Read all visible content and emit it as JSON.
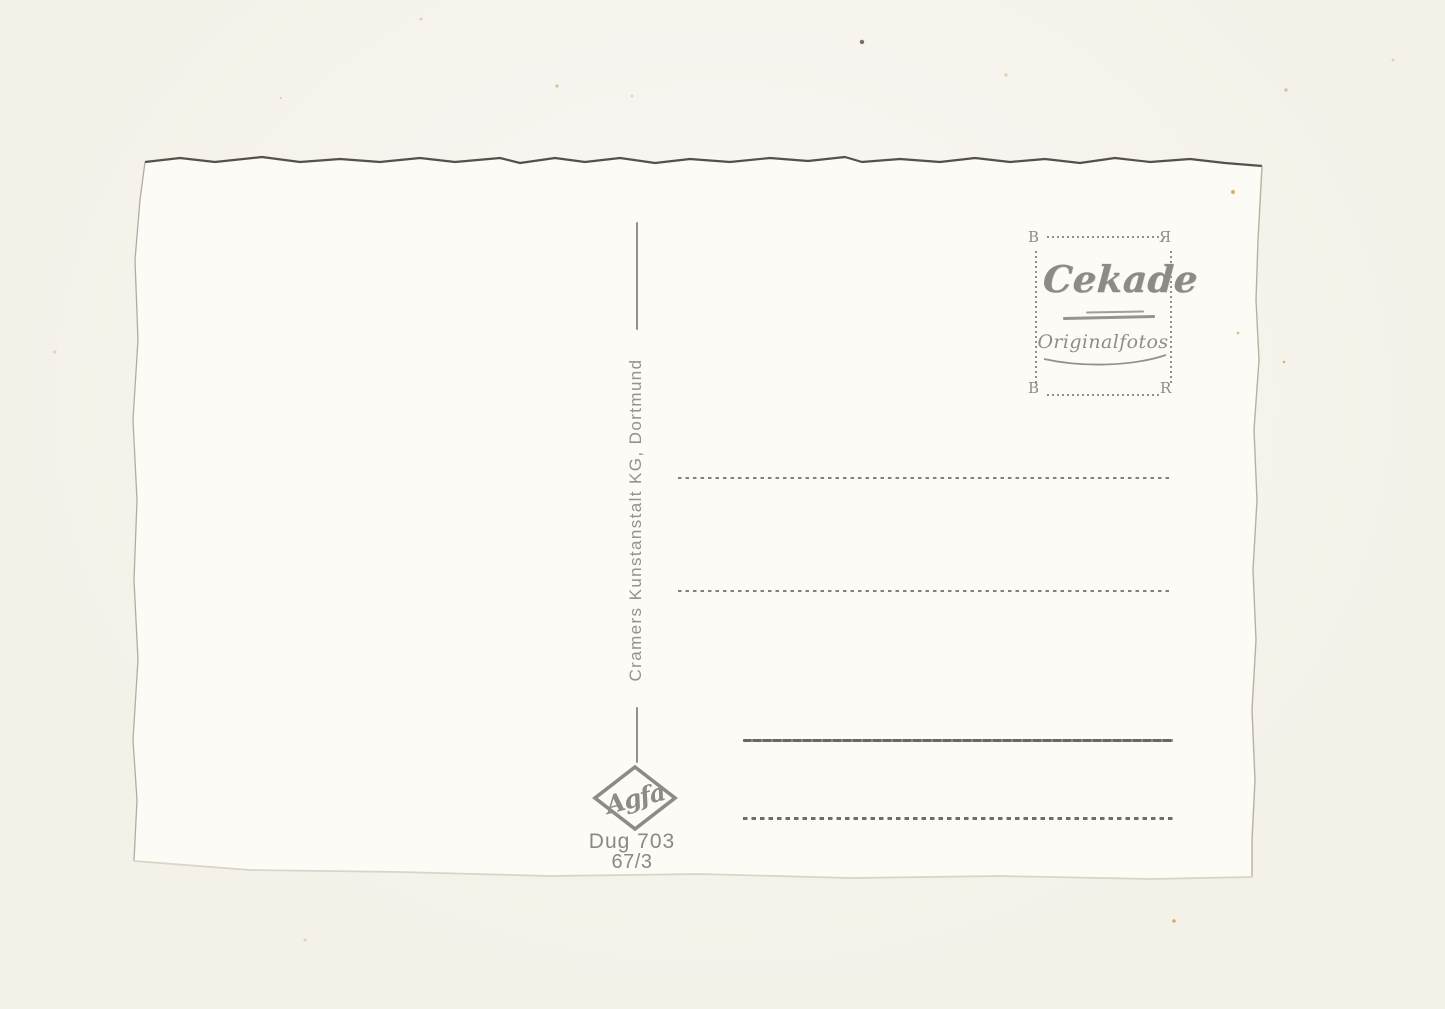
{
  "scan": {
    "background_color": "#f4f1e9",
    "card_color": "#fcfbf6"
  },
  "stamp_box": {
    "corner_tl": "B",
    "corner_tr": "Я",
    "corner_bl": "B",
    "corner_br": "R",
    "brand": "Cekade",
    "subtitle": "Originalfotos"
  },
  "publisher": {
    "label": "Cramers  Kunstanstalt  KG,  Dortmund"
  },
  "film_logo": {
    "label": "Agfa"
  },
  "print_code": {
    "line1": "Dug 703",
    "line2": "67/3"
  }
}
